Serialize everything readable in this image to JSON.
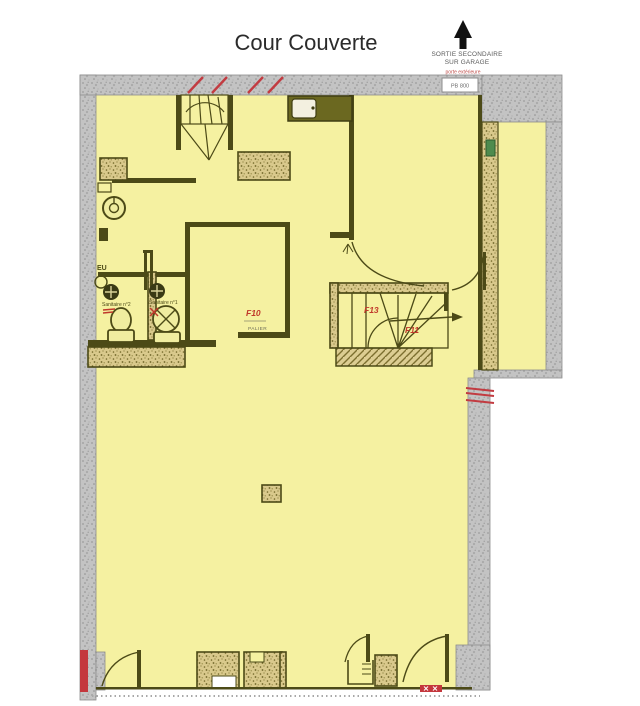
{
  "title": "Cour Couverte",
  "exit_annotation": {
    "line1": "SORTIE SECONDAIRE",
    "line2": "SUR GARAGE",
    "note": "porte extérieure",
    "door_ref": "PB 800"
  },
  "room_labels": {
    "sanitaire_2": "Sanitaire n°2",
    "sanitaire_1": "Sanitaire n°1",
    "f10": "F10",
    "palier": "PALIER",
    "f13": "F13",
    "f11": "F11",
    "eu": "EU"
  },
  "colors": {
    "floor_yellow": "#f5f1a1",
    "wall_gray": "#c2c2c2",
    "wall_olive": "#4c4a17",
    "hatch_tan": "#d9c98c",
    "accent_red": "#c0392b",
    "accent_green": "#4e8b4e"
  }
}
